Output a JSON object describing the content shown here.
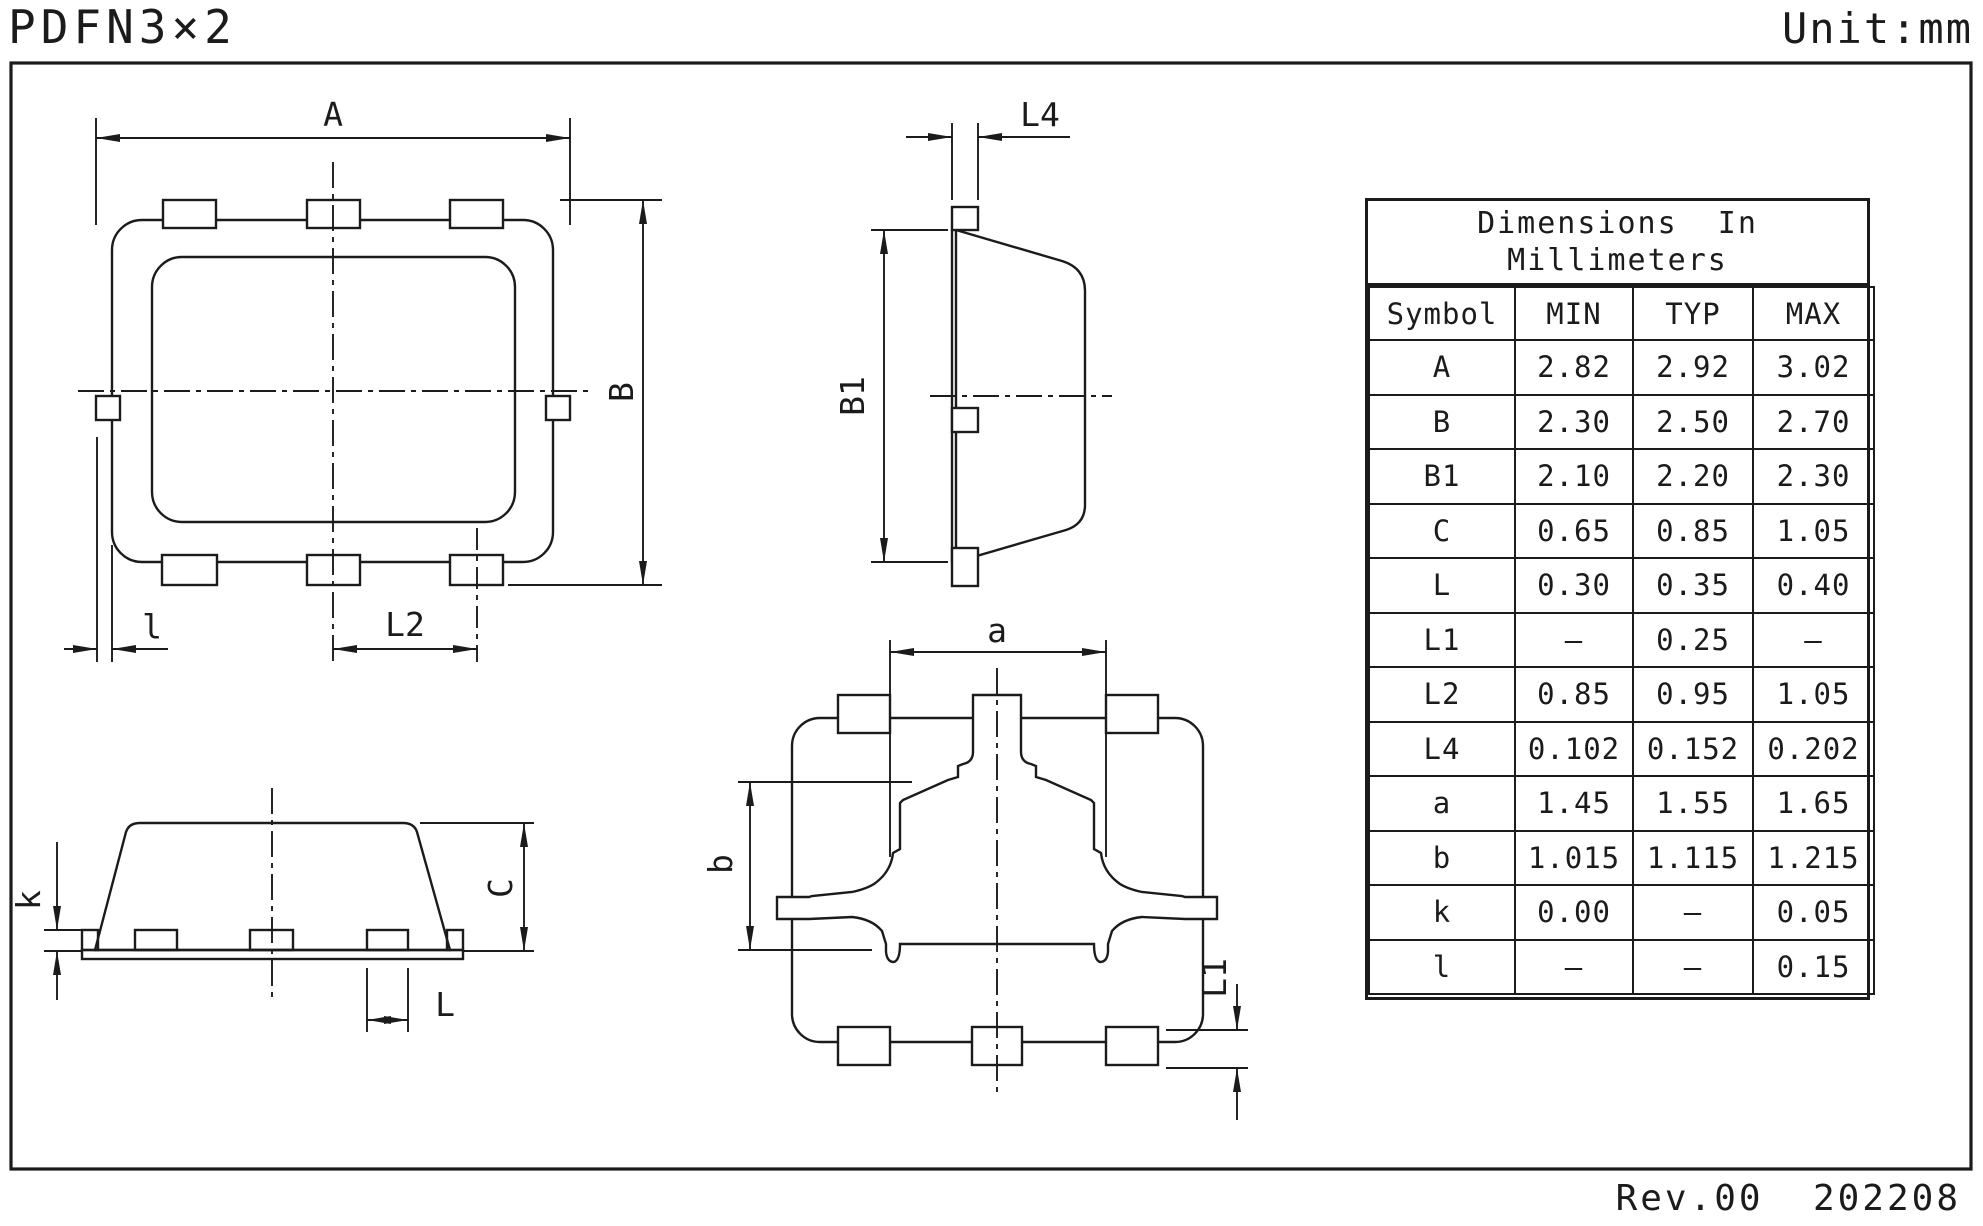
{
  "header": {
    "title": "PDFN3×2",
    "unit": "Unit:mm"
  },
  "footer": {
    "revision": "Rev.00  202208"
  },
  "table": {
    "title_line1": "Dimensions  In",
    "title_line2": "Millimeters",
    "columns": [
      "Symbol",
      "MIN",
      "TYP",
      "MAX"
    ],
    "rows": [
      [
        "A",
        "2.82",
        "2.92",
        "3.02"
      ],
      [
        "B",
        "2.30",
        "2.50",
        "2.70"
      ],
      [
        "B1",
        "2.10",
        "2.20",
        "2.30"
      ],
      [
        "C",
        "0.65",
        "0.85",
        "1.05"
      ],
      [
        "L",
        "0.30",
        "0.35",
        "0.40"
      ],
      [
        "L1",
        "–",
        "0.25",
        "–"
      ],
      [
        "L2",
        "0.85",
        "0.95",
        "1.05"
      ],
      [
        "L4",
        "0.102",
        "0.152",
        "0.202"
      ],
      [
        "a",
        "1.45",
        "1.55",
        "1.65"
      ],
      [
        "b",
        "1.015",
        "1.115",
        "1.215"
      ],
      [
        "k",
        "0.00",
        "–",
        "0.05"
      ],
      [
        "l",
        "–",
        "–",
        "0.15"
      ]
    ]
  },
  "drawing": {
    "labels": {
      "A": "A",
      "B": "B",
      "B1": "B1",
      "L4": "L4",
      "L2": "L2",
      "l": "l",
      "k": "k",
      "C": "C",
      "L": "L",
      "a": "a",
      "b": "b",
      "L1": "L1"
    }
  },
  "colors": {
    "ink": "#1b1b1b",
    "paper": "#ffffff"
  }
}
